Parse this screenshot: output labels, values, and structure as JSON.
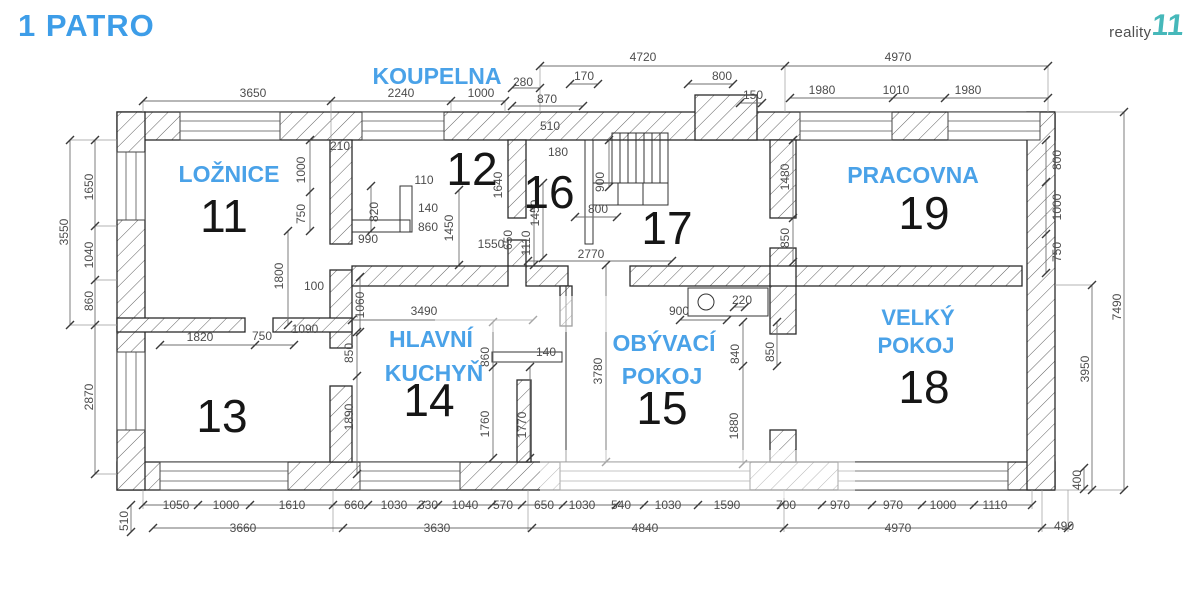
{
  "header": {
    "title": "1 PATRO",
    "logo_text": "reality",
    "logo_mark": "11"
  },
  "colors": {
    "title_blue": "#3d9de8",
    "room_blue": "#4aa2e8",
    "dim_gray": "#4d4d4d",
    "wall_line": "#2b2b2b",
    "logo_teal": "#46b8ba",
    "logo_gray": "#4f4f4f"
  },
  "plan": {
    "rooms": [
      {
        "number": "11",
        "number_pos": [
          224,
          232
        ],
        "name_lines": [
          {
            "text": "LOŽNICE",
            "x": 229,
            "y": 182
          }
        ]
      },
      {
        "number": "12",
        "number_pos": [
          472,
          185
        ],
        "name_lines": [
          {
            "text": "KOUPELNA",
            "x": 437,
            "y": 84
          }
        ]
      },
      {
        "number": "13",
        "number_pos": [
          222,
          432
        ],
        "name_lines": []
      },
      {
        "number": "14",
        "number_pos": [
          429,
          416
        ],
        "name_lines": [
          {
            "text": "HLAVNÍ",
            "x": 431,
            "y": 347
          },
          {
            "text": "KUCHYŇ",
            "x": 434,
            "y": 381
          }
        ]
      },
      {
        "number": "15",
        "number_pos": [
          662,
          424
        ],
        "name_lines": [
          {
            "text": "OBÝVACÍ",
            "x": 664,
            "y": 351
          },
          {
            "text": "POKOJ",
            "x": 662,
            "y": 384
          }
        ]
      },
      {
        "number": "16",
        "number_pos": [
          549,
          208
        ],
        "name_lines": []
      },
      {
        "number": "17",
        "number_pos": [
          667,
          244
        ],
        "name_lines": []
      },
      {
        "number": "18",
        "number_pos": [
          924,
          403
        ],
        "name_lines": [
          {
            "text": "VELKÝ",
            "x": 918,
            "y": 325,
            "size": 22
          },
          {
            "text": "POKOJ",
            "x": 916,
            "y": 353,
            "size": 22
          }
        ]
      },
      {
        "number": "19",
        "number_pos": [
          924,
          229
        ],
        "name_lines": [
          {
            "text": "PRACOVNA",
            "x": 913,
            "y": 183
          }
        ]
      }
    ],
    "dimensions": [
      {
        "v": "4720",
        "x": 643,
        "y": 61
      },
      {
        "v": "4970",
        "x": 898,
        "y": 61
      },
      {
        "v": "3650",
        "x": 253,
        "y": 97
      },
      {
        "v": "2240",
        "x": 401,
        "y": 97
      },
      {
        "v": "1000",
        "x": 481,
        "y": 97
      },
      {
        "v": "280",
        "x": 523,
        "y": 86
      },
      {
        "v": "870",
        "x": 547,
        "y": 103
      },
      {
        "v": "170",
        "x": 584,
        "y": 80
      },
      {
        "v": "800",
        "x": 722,
        "y": 80
      },
      {
        "v": "150",
        "x": 753,
        "y": 99
      },
      {
        "v": "1980",
        "x": 822,
        "y": 94
      },
      {
        "v": "1010",
        "x": 896,
        "y": 94
      },
      {
        "v": "1980",
        "x": 968,
        "y": 94
      },
      {
        "v": "3550",
        "x": 68,
        "y": 232,
        "r": 1
      },
      {
        "v": "1650",
        "x": 93,
        "y": 187,
        "r": 1
      },
      {
        "v": "1040",
        "x": 93,
        "y": 255,
        "r": 1
      },
      {
        "v": "860",
        "x": 93,
        "y": 301,
        "r": 1
      },
      {
        "v": "2870",
        "x": 93,
        "y": 397,
        "r": 1
      },
      {
        "v": "510",
        "x": 128,
        "y": 521,
        "r": 1
      },
      {
        "v": "7490",
        "x": 1121,
        "y": 307,
        "r": 1
      },
      {
        "v": "3950",
        "x": 1089,
        "y": 369,
        "r": 1
      },
      {
        "v": "400",
        "x": 1081,
        "y": 480,
        "r": 1
      },
      {
        "v": "800",
        "x": 1061,
        "y": 160,
        "r": 1
      },
      {
        "v": "1000",
        "x": 1061,
        "y": 207,
        "r": 1
      },
      {
        "v": "750",
        "x": 1061,
        "y": 252,
        "r": 1
      },
      {
        "v": "210",
        "x": 340,
        "y": 150
      },
      {
        "v": "1000",
        "x": 305,
        "y": 170,
        "r": 1
      },
      {
        "v": "750",
        "x": 305,
        "y": 214,
        "r": 1
      },
      {
        "v": "1800",
        "x": 283,
        "y": 276,
        "r": 1
      },
      {
        "v": "100",
        "x": 314,
        "y": 290
      },
      {
        "v": "990",
        "x": 368,
        "y": 243
      },
      {
        "v": "820",
        "x": 378,
        "y": 212,
        "r": 1
      },
      {
        "v": "1090",
        "x": 305,
        "y": 333
      },
      {
        "v": "1820",
        "x": 200,
        "y": 341
      },
      {
        "v": "750",
        "x": 262,
        "y": 340
      },
      {
        "v": "110",
        "x": 424,
        "y": 184
      },
      {
        "v": "140",
        "x": 428,
        "y": 212
      },
      {
        "v": "860",
        "x": 428,
        "y": 231
      },
      {
        "v": "1450",
        "x": 453,
        "y": 228,
        "r": 1
      },
      {
        "v": "1550",
        "x": 491,
        "y": 248
      },
      {
        "v": "650",
        "x": 512,
        "y": 240,
        "r": 1
      },
      {
        "v": "1640",
        "x": 502,
        "y": 185,
        "r": 1
      },
      {
        "v": "510",
        "x": 550,
        "y": 130
      },
      {
        "v": "180",
        "x": 558,
        "y": 156
      },
      {
        "v": "1450",
        "x": 539,
        "y": 213,
        "r": 1
      },
      {
        "v": "900",
        "x": 604,
        "y": 182,
        "r": 1
      },
      {
        "v": "800",
        "x": 598,
        "y": 213
      },
      {
        "v": "1110",
        "x": 530,
        "y": 243,
        "r": 1
      },
      {
        "v": "2770",
        "x": 591,
        "y": 258
      },
      {
        "v": "1480",
        "x": 789,
        "y": 177,
        "r": 1
      },
      {
        "v": "850",
        "x": 789,
        "y": 238,
        "r": 1
      },
      {
        "v": "1060",
        "x": 364,
        "y": 305,
        "r": 1
      },
      {
        "v": "3490",
        "x": 424,
        "y": 315
      },
      {
        "v": "850",
        "x": 353,
        "y": 353,
        "r": 1
      },
      {
        "v": "1890",
        "x": 353,
        "y": 417,
        "r": 1
      },
      {
        "v": "860",
        "x": 489,
        "y": 357,
        "r": 1
      },
      {
        "v": "140",
        "x": 546,
        "y": 356
      },
      {
        "v": "1760",
        "x": 489,
        "y": 424,
        "r": 1
      },
      {
        "v": "1770",
        "x": 526,
        "y": 425,
        "r": 1
      },
      {
        "v": "3780",
        "x": 602,
        "y": 371,
        "r": 1
      },
      {
        "v": "900",
        "x": 679,
        "y": 315
      },
      {
        "v": "220",
        "x": 742,
        "y": 304
      },
      {
        "v": "840",
        "x": 739,
        "y": 354,
        "r": 1
      },
      {
        "v": "1880",
        "x": 738,
        "y": 426,
        "r": 1
      },
      {
        "v": "850",
        "x": 774,
        "y": 352,
        "r": 1
      },
      {
        "v": "1050",
        "x": 176,
        "y": 509
      },
      {
        "v": "1000",
        "x": 226,
        "y": 509
      },
      {
        "v": "1610",
        "x": 292,
        "y": 509
      },
      {
        "v": "660",
        "x": 354,
        "y": 509
      },
      {
        "v": "1030",
        "x": 394,
        "y": 509
      },
      {
        "v": "330",
        "x": 428,
        "y": 509
      },
      {
        "v": "1040",
        "x": 465,
        "y": 509
      },
      {
        "v": "570",
        "x": 503,
        "y": 509
      },
      {
        "v": "650",
        "x": 544,
        "y": 509
      },
      {
        "v": "1030",
        "x": 582,
        "y": 509
      },
      {
        "v": "540",
        "x": 621,
        "y": 509
      },
      {
        "v": "1030",
        "x": 668,
        "y": 509
      },
      {
        "v": "1590",
        "x": 727,
        "y": 509
      },
      {
        "v": "700",
        "x": 786,
        "y": 509
      },
      {
        "v": "970",
        "x": 840,
        "y": 509
      },
      {
        "v": "970",
        "x": 893,
        "y": 509
      },
      {
        "v": "1000",
        "x": 943,
        "y": 509
      },
      {
        "v": "1110",
        "x": 995,
        "y": 509
      },
      {
        "v": "3660",
        "x": 243,
        "y": 532
      },
      {
        "v": "3630",
        "x": 437,
        "y": 532
      },
      {
        "v": "4840",
        "x": 645,
        "y": 532
      },
      {
        "v": "4970",
        "x": 898,
        "y": 532
      },
      {
        "v": "490",
        "x": 1064,
        "y": 530
      }
    ]
  }
}
